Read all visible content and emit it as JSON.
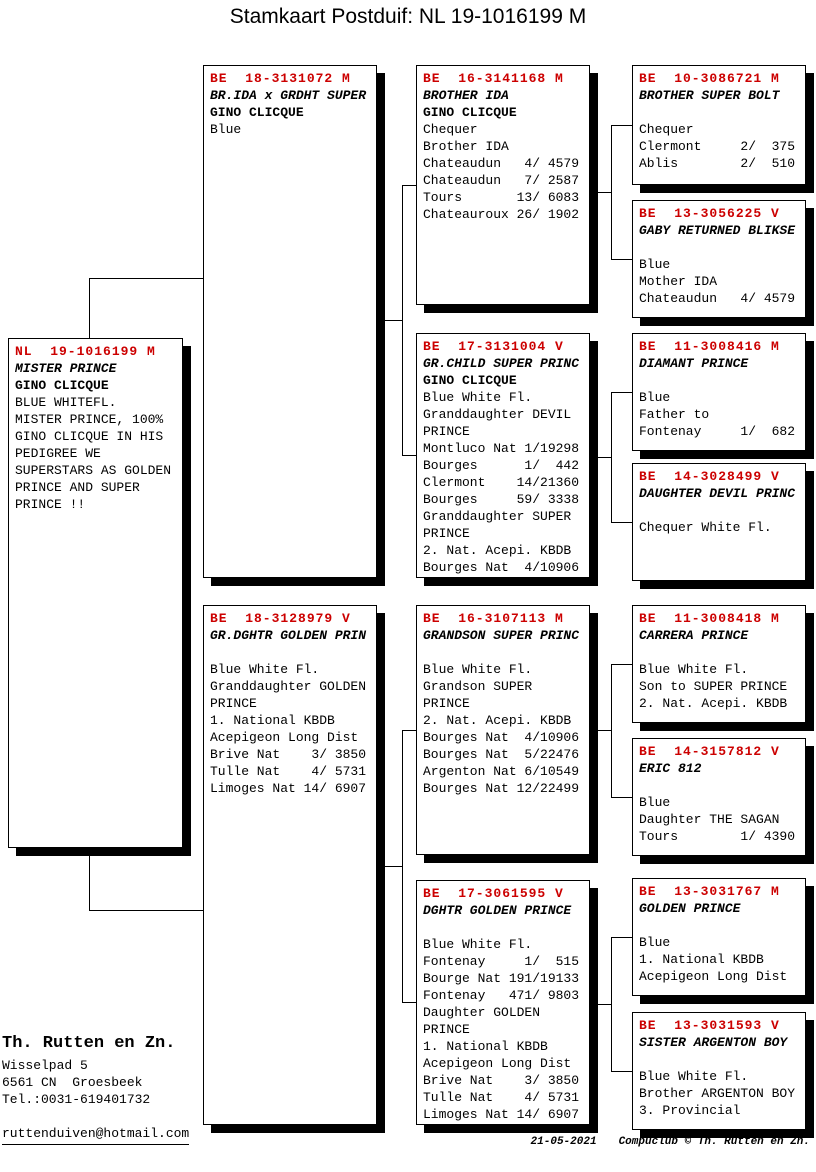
{
  "title": "Stamkaart Postduif: NL  19-1016199 M",
  "colors": {
    "header_red": "#cc0000",
    "line_black": "#000000",
    "background": "#ffffff"
  },
  "boxes": {
    "subject": {
      "header": "NL  19-1016199 M",
      "name": "MISTER PRINCE",
      "name2": "GINO CLICQUE",
      "body": "BLUE WHITEFL.\nMISTER PRINCE, 100%\nGINO CLICQUE IN HIS\nPEDIGREE WE\nSUPERSTARS AS GOLDEN\nPRINCE AND SUPER\nPRINCE !!"
    },
    "g2": [
      {
        "header": "BE  18-3131072 M",
        "name": "BR.IDA x GRDHT SUPER",
        "name2": "GINO CLICQUE",
        "body": "Blue"
      },
      {
        "header": "BE  18-3128979 V",
        "name": "GR.DGHTR GOLDEN PRIN",
        "name2": "",
        "body": "Blue White Fl.\nGranddaughter GOLDEN\nPRINCE\n1. National KBDB\nAcepigeon Long Dist\nBrive Nat    3/ 3850\nTulle Nat    4/ 5731\nLimoges Nat 14/ 6907"
      }
    ],
    "g3": [
      {
        "header": "BE  16-3141168 M",
        "name": "BROTHER IDA",
        "name2": "GINO CLICQUE",
        "body": "Chequer\nBrother IDA\nChateaudun   4/ 4579\nChateaudun   7/ 2587\nTours       13/ 6083\nChateauroux 26/ 1902"
      },
      {
        "header": "BE  17-3131004 V",
        "name": "GR.CHILD SUPER PRINC",
        "name2": "GINO CLICQUE",
        "body": "Blue White Fl.\nGranddaughter DEVIL\nPRINCE\nMontluco Nat 1/19298\nBourges      1/  442\nClermont    14/21360\nBourges     59/ 3338\nGranddaughter SUPER\nPRINCE\n2. Nat. Acepi. KBDB\nBourges Nat  4/10906"
      },
      {
        "header": "BE  16-3107113 M",
        "name": "GRANDSON SUPER PRINC",
        "name2": "",
        "body": "Blue White Fl.\nGrandson SUPER\nPRINCE\n2. Nat. Acepi. KBDB\nBourges Nat  4/10906\nBourges Nat  5/22476\nArgenton Nat 6/10549\nBourges Nat 12/22499"
      },
      {
        "header": "BE  17-3061595 V",
        "name": "DGHTR GOLDEN PRINCE",
        "name2": "",
        "body": "Blue White Fl.\nFontenay     1/  515\nBourge Nat 191/19133\nFontenay   471/ 9803\nDaughter GOLDEN\nPRINCE\n1. National KBDB\nAcepigeon Long Dist\nBrive Nat    3/ 3850\nTulle Nat    4/ 5731\nLimoges Nat 14/ 6907"
      }
    ],
    "g4": [
      {
        "header": "BE  10-3086721 M",
        "name": "BROTHER SUPER BOLT",
        "name2": "",
        "body": "Chequer\nClermont     2/  375\nAblis        2/  510"
      },
      {
        "header": "BE  13-3056225 V",
        "name": "GABY RETURNED BLIKSE",
        "name2": "",
        "body": "Blue\nMother IDA\nChateaudun   4/ 4579"
      },
      {
        "header": "BE  11-3008416 M",
        "name": "DIAMANT PRINCE",
        "name2": "",
        "body": "Blue\nFather to\nFontenay     1/  682"
      },
      {
        "header": "BE  14-3028499 V",
        "name": "DAUGHTER DEVIL PRINC",
        "name2": "",
        "body": "Chequer White Fl."
      },
      {
        "header": "BE  11-3008418 M",
        "name": "CARRERA PRINCE",
        "name2": "",
        "body": "Blue White Fl.\nSon to SUPER PRINCE\n2. Nat. Acepi. KBDB"
      },
      {
        "header": "BE  14-3157812 V",
        "name": "ERIC 812",
        "name2": "",
        "body": "Blue\nDaughter THE SAGAN\nTours        1/ 4390"
      },
      {
        "header": "BE  13-3031767 M",
        "name": "GOLDEN PRINCE",
        "name2": "",
        "body": "Blue\n1. National KBDB\nAcepigeon Long Dist"
      },
      {
        "header": "BE  13-3031593 V",
        "name": "SISTER ARGENTON BOY",
        "name2": "",
        "body": "Blue White Fl.\nBrother ARGENTON BOY\n3. Provincial"
      }
    ]
  },
  "breeder": {
    "name": "Th. Rutten en Zn.",
    "address": "Wisselpad 5\n6561 CN  Groesbeek\nTel.:0031-619401732",
    "email": "ruttenduiven@hotmail.com"
  },
  "footer": {
    "date": "21-05-2021",
    "credit": "Compuclub © Th. Rutten en Zn."
  }
}
